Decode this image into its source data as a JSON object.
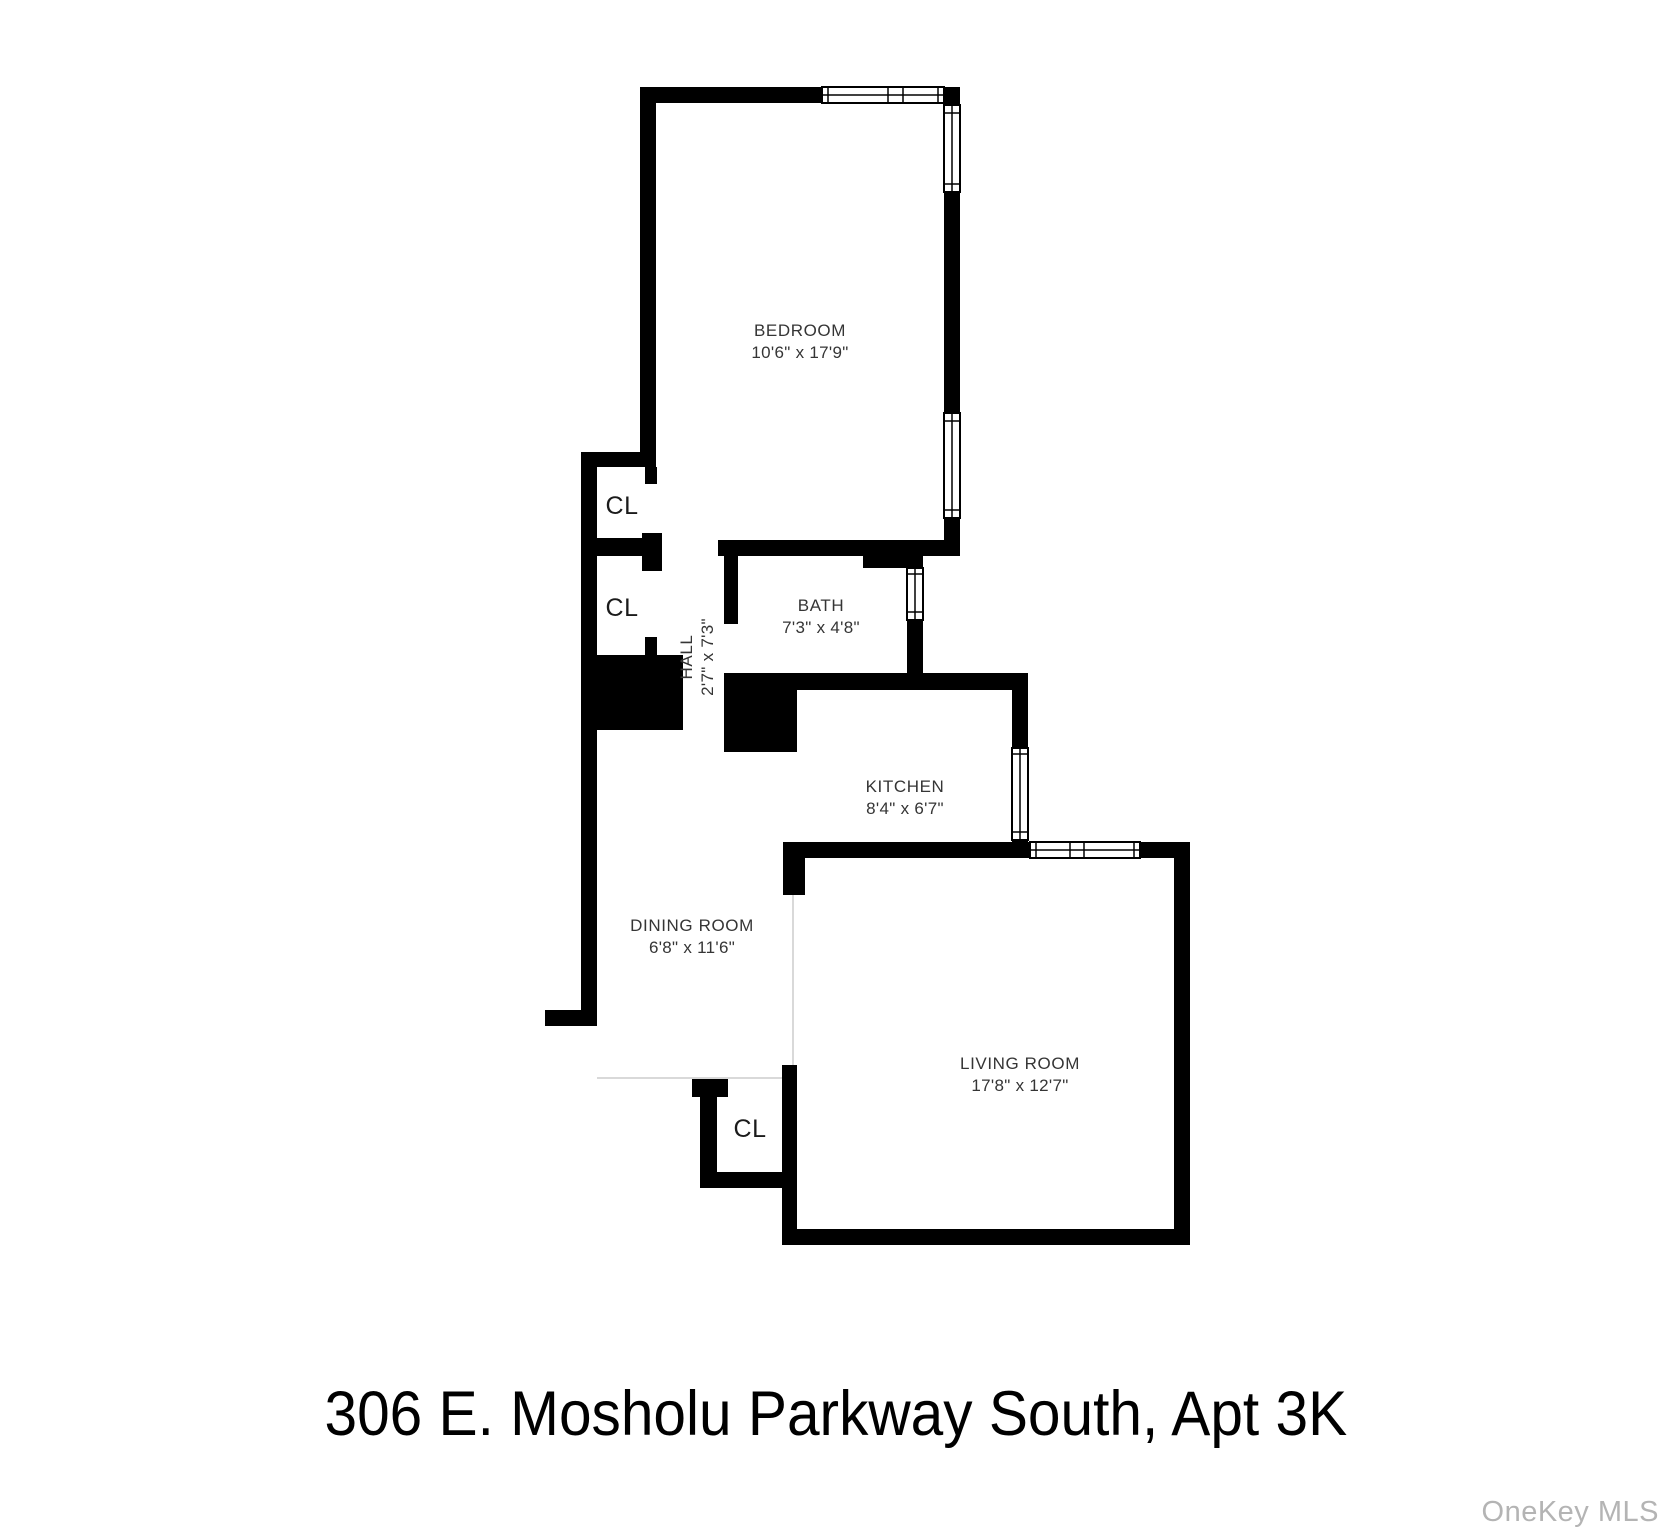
{
  "page": {
    "title": "306 E. Mosholu Parkway South, Apt 3K",
    "watermark": "OneKey MLS",
    "background": "#ffffff"
  },
  "colors": {
    "wall": "#000000",
    "window_fill": "#ffffff",
    "window_stroke": "#000000",
    "label": "#353535",
    "closet_label": "#1b1b1b",
    "open_boundary_line": "#d9d9d9",
    "watermark": "#b4b4b4"
  },
  "rooms": [
    {
      "id": "bedroom",
      "name": "BEDROOM",
      "dims": "10'6\" x 17'9\""
    },
    {
      "id": "bath",
      "name": "BATH",
      "dims": "7'3\" x 4'8\""
    },
    {
      "id": "hall",
      "name": "HALL",
      "dims": "2'7\" x 7'3\""
    },
    {
      "id": "kitchen",
      "name": "KITCHEN",
      "dims": "8'4\" x 6'7\""
    },
    {
      "id": "dining",
      "name": "DINING ROOM",
      "dims": "6'8\" x 11'6\""
    },
    {
      "id": "living",
      "name": "LIVING ROOM",
      "dims": "17'8\" x 12'7\""
    },
    {
      "id": "closet-upper",
      "name": "CL"
    },
    {
      "id": "closet-lower",
      "name": "CL"
    },
    {
      "id": "closet-entry",
      "name": "CL"
    }
  ]
}
